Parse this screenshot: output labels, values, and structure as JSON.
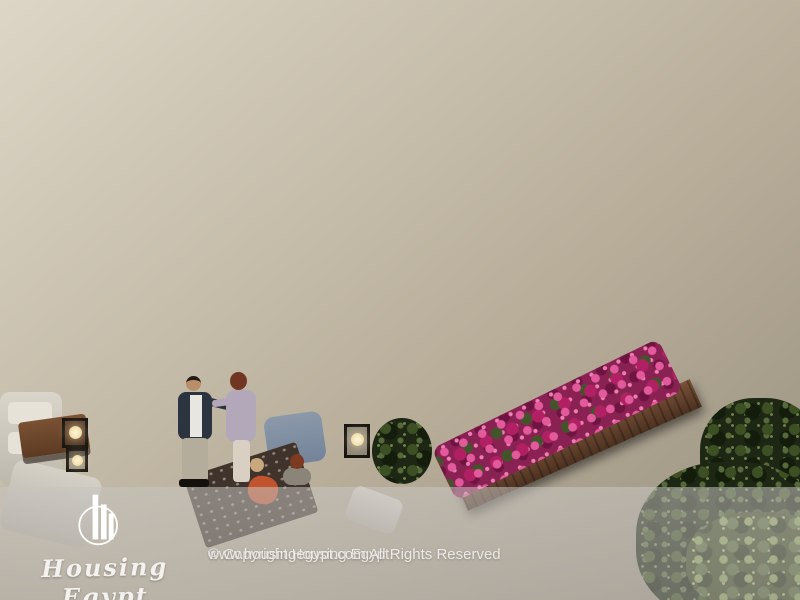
{
  "meta": {
    "kind": "watermarked architectural dusk render",
    "canvas": {
      "width": 800,
      "height": 600
    }
  },
  "scene": {
    "description": "Aerial dusk 3D rendering of a cream-stone apartment building: a roof terrace with a couple seated on a lounge chair beneath a cantilevered bougainvillea planter, warm lit windows and glass doors, a lower wooden deck terrace where a man and a woman greet beside lantern lamps and white sofas, a second magenta bougainvillea planter box, recessed balconies with plants, and dark foliage in the lower right.",
    "palette": {
      "facade_light": "#d8d1c0",
      "facade_shadow": "#8a8173",
      "deck_wood": "#5d3a26",
      "terracotta_floor": "#8f5d3c",
      "planter_plum": "#4e3340",
      "bougainvillea_magenta": "#cc2f77",
      "window_glow": "#f0dcab",
      "foliage_dark": "#2c3a1e",
      "curtain_white": "#f4efe5"
    }
  },
  "watermark": {
    "overlay_color": "rgba(197,194,190,0.52)",
    "logo_icon": "housing-egypt-skyline-circle-logo",
    "brand": "Housing Egypt",
    "copyright_line1": "© Copyright Housing Egypt.",
    "copyright_line2": "www.housingegypt.com All Rights Reserved"
  }
}
